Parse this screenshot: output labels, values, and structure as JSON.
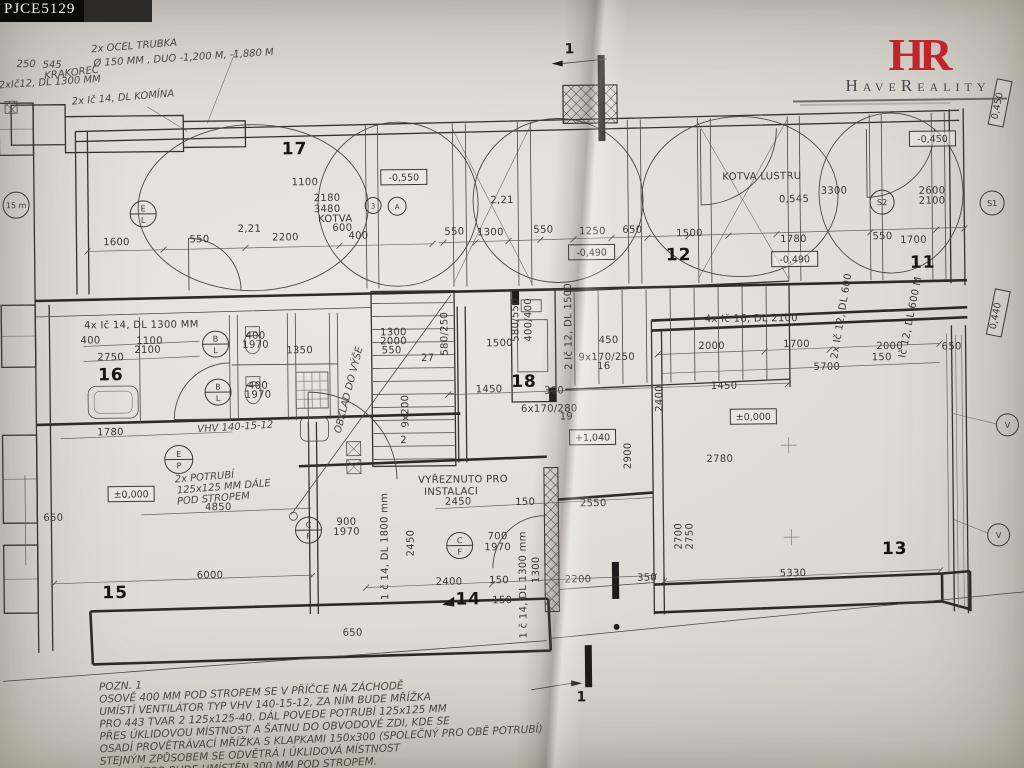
{
  "header": {
    "plan_code": "PJCE5129"
  },
  "logo": {
    "monogram": "HR",
    "name": "HaveReality"
  },
  "plan": {
    "rooms": [
      {
        "t": "17",
        "x": 297,
        "y": 152
      },
      {
        "t": "12",
        "x": 680,
        "y": 262
      },
      {
        "t": "11",
        "x": 924,
        "y": 272
      },
      {
        "t": "16",
        "x": 111,
        "y": 376
      },
      {
        "t": "18",
        "x": 524,
        "y": 387
      },
      {
        "t": "15",
        "x": 113,
        "y": 594
      },
      {
        "t": "14",
        "x": 466,
        "y": 604
      },
      {
        "t": "13",
        "x": 893,
        "y": 558
      }
    ],
    "levels": [
      {
        "t": "-0,550",
        "x": 406,
        "y": 176
      },
      {
        "t": "-0,490",
        "x": 593,
        "y": 253
      },
      {
        "t": "-0,450",
        "x": 935,
        "y": 143
      },
      {
        "t": "-0,490",
        "x": 796,
        "y": 262
      },
      {
        "t": "±0,000",
        "x": 130,
        "y": 490
      },
      {
        "t": "±0,000",
        "x": 753,
        "y": 419
      },
      {
        "t": "+1,040",
        "x": 592,
        "y": 438
      },
      {
        "t": "0,450",
        "x": 1003,
        "y": 108,
        "r": -78
      },
      {
        "t": "0,440",
        "x": 999,
        "y": 318,
        "r": -78
      }
    ],
    "circles": [
      {
        "x": 145,
        "y": 210,
        "r": 13,
        "a": "E",
        "b": "L"
      },
      {
        "x": 375,
        "y": 204,
        "r": 8,
        "t": "3"
      },
      {
        "x": 399,
        "y": 205,
        "r": 9,
        "t": "A"
      },
      {
        "x": 884,
        "y": 206,
        "r": 12,
        "t": "S2"
      },
      {
        "x": 994,
        "y": 208,
        "r": 12,
        "t": "S1"
      },
      {
        "x": 216,
        "y": 341,
        "r": 13,
        "a": "B",
        "b": "L"
      },
      {
        "x": 218,
        "y": 389,
        "r": 13,
        "a": "B",
        "b": "L"
      },
      {
        "x": 178,
        "y": 456,
        "r": 14,
        "a": "E",
        "b": "P"
      },
      {
        "x": 307,
        "y": 528,
        "r": 13,
        "a": "C",
        "b": "F"
      },
      {
        "x": 458,
        "y": 545,
        "r": 13,
        "a": "C",
        "b": "F"
      },
      {
        "x": 1007,
        "y": 430,
        "r": 11,
        "t": "V"
      },
      {
        "x": 997,
        "y": 540,
        "r": 11,
        "t": "V"
      },
      {
        "x": 18,
        "y": 200,
        "r": 13,
        "t": "15 m"
      }
    ],
    "labels": [
      {
        "t": "2x OCEL TRUBKA",
        "x": 95,
        "y": 48,
        "s": 11,
        "r": -4,
        "c": "hand"
      },
      {
        "t": "Ø 150 MM , DUO -1,200 M, -1,880 M",
        "x": 97,
        "y": 62,
        "s": 11,
        "r": -3,
        "c": "hand"
      },
      {
        "t": "250",
        "x": 20,
        "y": 62,
        "s": 8,
        "c": "hand"
      },
      {
        "t": "545",
        "x": 46,
        "y": 63,
        "s": 8,
        "c": "hand"
      },
      {
        "t": "KRAKOREC",
        "x": 48,
        "y": 74,
        "s": 7,
        "r": -6,
        "c": "hand"
      },
      {
        "t": "2xIč12, DL 1300 MM",
        "x": 2,
        "y": 83,
        "s": 9,
        "r": -3,
        "c": "hand"
      },
      {
        "t": "2x Ič 14, DL KOMÍNA",
        "x": 75,
        "y": 100,
        "s": 10,
        "r": -4,
        "c": "hand"
      },
      {
        "t": "1600",
        "x": 118,
        "y": 241
      },
      {
        "t": "550",
        "x": 201,
        "y": 239
      },
      {
        "t": "2200",
        "x": 287,
        "y": 238
      },
      {
        "t": "400",
        "x": 360,
        "y": 237
      },
      {
        "t": "1100",
        "x": 307,
        "y": 183,
        "s": 9
      },
      {
        "t": "2180",
        "x": 329,
        "y": 199,
        "s": 9
      },
      {
        "t": "3480",
        "x": 329,
        "y": 210,
        "s": 9
      },
      {
        "t": "KOTVA",
        "x": 337,
        "y": 220,
        "s": 7
      },
      {
        "t": "600",
        "x": 344,
        "y": 229,
        "s": 9
      },
      {
        "t": "2,21",
        "x": 251,
        "y": 229,
        "s": 9
      },
      {
        "t": "2,21",
        "x": 504,
        "y": 203,
        "s": 9
      },
      {
        "t": "550",
        "x": 456,
        "y": 234
      },
      {
        "t": "1300",
        "x": 492,
        "y": 235
      },
      {
        "t": "550",
        "x": 545,
        "y": 233
      },
      {
        "t": "1250",
        "x": 594,
        "y": 235
      },
      {
        "t": "650",
        "x": 634,
        "y": 234
      },
      {
        "t": "1500",
        "x": 691,
        "y": 238
      },
      {
        "t": "KOTVA LUSTRU",
        "x": 764,
        "y": 182,
        "s": 9
      },
      {
        "t": "0,545",
        "x": 796,
        "y": 205,
        "s": 9
      },
      {
        "t": "3300",
        "x": 836,
        "y": 197,
        "s": 8
      },
      {
        "t": "2600",
        "x": 934,
        "y": 198,
        "s": 8
      },
      {
        "t": "2100",
        "x": 934,
        "y": 208,
        "s": 8
      },
      {
        "t": "1780",
        "x": 795,
        "y": 245
      },
      {
        "t": "550",
        "x": 884,
        "y": 243
      },
      {
        "t": "1700",
        "x": 915,
        "y": 247
      },
      {
        "t": "650",
        "x": 952,
        "y": 354,
        "s": 9
      },
      {
        "t": "150",
        "x": 882,
        "y": 364,
        "s": 8
      },
      {
        "t": "Ič 12, DL 600 M",
        "x": 914,
        "y": 322,
        "s": 7,
        "r": -78
      },
      {
        "t": "2x Ič 12, DL 600",
        "x": 845,
        "y": 320,
        "s": 7,
        "r": -80
      },
      {
        "t": "4x Ič 14, DL 1300 MM",
        "x": 142,
        "y": 324,
        "s": 10
      },
      {
        "t": "400",
        "x": 91,
        "y": 339,
        "s": 9
      },
      {
        "t": "1100",
        "x": 150,
        "y": 340,
        "s": 9
      },
      {
        "t": "2100",
        "x": 148,
        "y": 349,
        "s": 9
      },
      {
        "t": "2750",
        "x": 111,
        "y": 356,
        "s": 9
      },
      {
        "t": "400",
        "x": 256,
        "y": 336,
        "s": 8
      },
      {
        "t": "1970",
        "x": 256,
        "y": 345,
        "s": 8
      },
      {
        "t": "1350",
        "x": 300,
        "y": 351,
        "s": 8
      },
      {
        "t": "400",
        "x": 258,
        "y": 386,
        "s": 8
      },
      {
        "t": "1970",
        "x": 258,
        "y": 395,
        "s": 8
      },
      {
        "t": "1780",
        "x": 110,
        "y": 431
      },
      {
        "t": "VHV 140-15-12",
        "x": 197,
        "y": 429,
        "s": 9,
        "r": -3,
        "c": "hand"
      },
      {
        "t": "2x POTRUBÍ",
        "x": 174,
        "y": 479,
        "s": 9,
        "r": -4,
        "c": "hand"
      },
      {
        "t": "125x125 MM DÁLE",
        "x": 176,
        "y": 490,
        "s": 9,
        "r": -4,
        "c": "hand"
      },
      {
        "t": "POD STROPEM",
        "x": 176,
        "y": 501,
        "s": 9,
        "r": -4,
        "c": "hand"
      },
      {
        "t": "4850",
        "x": 217,
        "y": 507
      },
      {
        "t": "650",
        "x": 52,
        "y": 516,
        "s": 9
      },
      {
        "t": "6000",
        "x": 208,
        "y": 575
      },
      {
        "t": "900",
        "x": 345,
        "y": 523,
        "s": 9
      },
      {
        "t": "1970",
        "x": 345,
        "y": 533,
        "s": 9
      },
      {
        "t": "1300",
        "x": 394,
        "y": 334,
        "s": 8
      },
      {
        "t": "2000",
        "x": 394,
        "y": 343,
        "s": 8
      },
      {
        "t": "550",
        "x": 392,
        "y": 352,
        "s": 8
      },
      {
        "t": "27",
        "x": 428,
        "y": 360,
        "s": 8
      },
      {
        "t": "580/250",
        "x": 448,
        "y": 333,
        "s": 7,
        "r": -90
      },
      {
        "t": "9x200",
        "x": 408,
        "y": 410,
        "s": 8,
        "r": -90
      },
      {
        "t": "2",
        "x": 403,
        "y": 442,
        "s": 9
      },
      {
        "t": "1500",
        "x": 500,
        "y": 346
      },
      {
        "t": "580/550",
        "x": 519,
        "y": 320,
        "s": 7,
        "r": -90
      },
      {
        "t": "400/400",
        "x": 532,
        "y": 320,
        "s": 7,
        "r": -90
      },
      {
        "t": "2 Ič 12, DL 1500",
        "x": 572,
        "y": 327,
        "s": 7,
        "r": -90
      },
      {
        "t": "450",
        "x": 609,
        "y": 344,
        "s": 9
      },
      {
        "t": "9x170/250",
        "x": 607,
        "y": 361,
        "s": 8
      },
      {
        "t": "16",
        "x": 604,
        "y": 370,
        "s": 7
      },
      {
        "t": "1450",
        "x": 489,
        "y": 392
      },
      {
        "t": "300",
        "x": 554,
        "y": 394,
        "s": 9
      },
      {
        "t": "1450",
        "x": 724,
        "y": 391
      },
      {
        "t": "6x170/280",
        "x": 549,
        "y": 412,
        "s": 9
      },
      {
        "t": "19",
        "x": 566,
        "y": 420,
        "s": 7
      },
      {
        "t": "VYŘEZNUTO PRO",
        "x": 462,
        "y": 482,
        "s": 9
      },
      {
        "t": "INSTALACI",
        "x": 450,
        "y": 494,
        "s": 9
      },
      {
        "t": "2450",
        "x": 457,
        "y": 504
      },
      {
        "t": "150",
        "x": 524,
        "y": 505,
        "s": 9
      },
      {
        "t": "2550",
        "x": 592,
        "y": 507
      },
      {
        "t": "700",
        "x": 496,
        "y": 539,
        "s": 9
      },
      {
        "t": "1970",
        "x": 496,
        "y": 550,
        "s": 9
      },
      {
        "t": "2450",
        "x": 412,
        "y": 542,
        "s": 9,
        "r": -90
      },
      {
        "t": "1 č 14, DL 1800 mm",
        "x": 386,
        "y": 545,
        "s": 8,
        "r": -90
      },
      {
        "t": "OBKLAD DO VÝŠE",
        "x": 340,
        "y": 432,
        "s": 7,
        "r": -75,
        "c": "hand"
      },
      {
        "t": "2400",
        "x": 447,
        "y": 584
      },
      {
        "t": "150",
        "x": 497,
        "y": 583,
        "s": 9
      },
      {
        "t": "2200",
        "x": 576,
        "y": 583
      },
      {
        "t": "350",
        "x": 645,
        "y": 582,
        "s": 9
      },
      {
        "t": "1 č 14, DL 1300 mm",
        "x": 524,
        "y": 585,
        "s": 8,
        "r": -90
      },
      {
        "t": "1300",
        "x": 537,
        "y": 570,
        "s": 8,
        "r": -90
      },
      {
        "t": "150",
        "x": 500,
        "y": 603,
        "s": 7
      },
      {
        "t": "650",
        "x": 350,
        "y": 634
      },
      {
        "t": "4x Ič 16, DL 2100",
        "x": 752,
        "y": 324,
        "s": 9
      },
      {
        "t": "2000",
        "x": 712,
        "y": 351
      },
      {
        "t": "1700",
        "x": 797,
        "y": 350
      },
      {
        "t": "2000",
        "x": 890,
        "y": 353
      },
      {
        "t": "5700",
        "x": 827,
        "y": 373
      },
      {
        "t": "2780",
        "x": 719,
        "y": 464
      },
      {
        "t": "5330",
        "x": 791,
        "y": 579
      },
      {
        "t": "2700",
        "x": 680,
        "y": 538,
        "s": 9,
        "r": -90
      },
      {
        "t": "2750",
        "x": 691,
        "y": 538,
        "s": 8,
        "r": -90
      },
      {
        "t": "2900",
        "x": 630,
        "y": 457,
        "s": 9,
        "r": -90
      },
      {
        "t": "2400",
        "x": 662,
        "y": 400,
        "s": 8,
        "r": -90
      },
      {
        "t": "1",
        "x": 573,
        "y": 54,
        "c": "sec"
      },
      {
        "t": "1",
        "x": 578,
        "y": 702,
        "c": "sec"
      }
    ],
    "notes": {
      "x": 96,
      "y": 686,
      "lh": 12.4,
      "r": -2,
      "lines": [
        "POZN. 1",
        "OSOVĚ 400 MM POD STROPEM SE V PŘÍČCE NA ZÁCHODĚ",
        "UMÍSTÍ VENTILÁTOR TYP VHV 140-15-12, ZA NÍM BUDE MŘÍŽKA",
        "PRO 443 TVAR 2 125x125-40. DÁL POVEDE POTRUBÍ 125x125 MM",
        "PŘES ÚKLIDOVOU MÍSTNOST A ŠATNU DO OBVODOVÉ ZDI, KDE SE",
        "OSADÍ PROVĚTRÁVACÍ MŘÍŽKA S KLAPKAMI 150x300 (SPOLEČNÝ PRO OBĚ POTRUBÍ)",
        "STEJNÝM ZPŮSOBEM SE ODVĚTRÁ I ÚKLIDOVÁ MÍSTNOST",
        "VENTILÁTOR BUDE UMÍSTĚN 300 MM POD STROPEM."
      ]
    }
  }
}
